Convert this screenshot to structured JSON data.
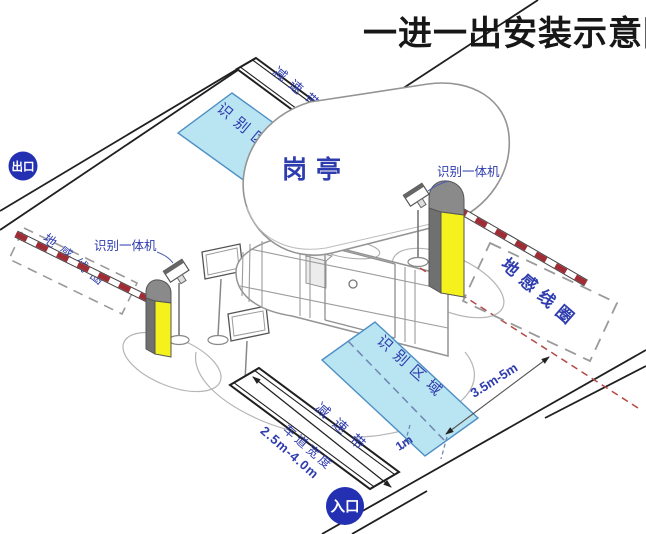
{
  "title": "一进一出安装示意图",
  "badges": {
    "exit": "出口",
    "entry": "入口"
  },
  "booth": {
    "label": "岗亭"
  },
  "labels": {
    "camera_left": "识别一体机",
    "camera_right": "识别一体机",
    "coil_left": "地感线圈",
    "coil_right": "地感线圈",
    "zone_exit": "识别区域",
    "zone_entry": "识别区域",
    "bump_exit": "减速带",
    "bump_entry": "减速带"
  },
  "dimensions": {
    "lane_width_label": "车道宽度",
    "lane_width_value": "2.5m-4.0m",
    "coil_offset": "3.5m-5m",
    "zone_offset": "1m"
  },
  "colors": {
    "label_blue": "#2e3cae",
    "badge_blue": "#2330b2",
    "zone_fill": "#b9e4f2",
    "zone_border": "#4d8fc4",
    "barrier_red": "#a02c36",
    "machine_yellow": "#f4f11d",
    "machine_gray": "#8a8a8a",
    "coil_dash_gray": "#9a9a9a",
    "wire_red_dash": "#b24a44",
    "line_black": "#1f1f1f"
  }
}
